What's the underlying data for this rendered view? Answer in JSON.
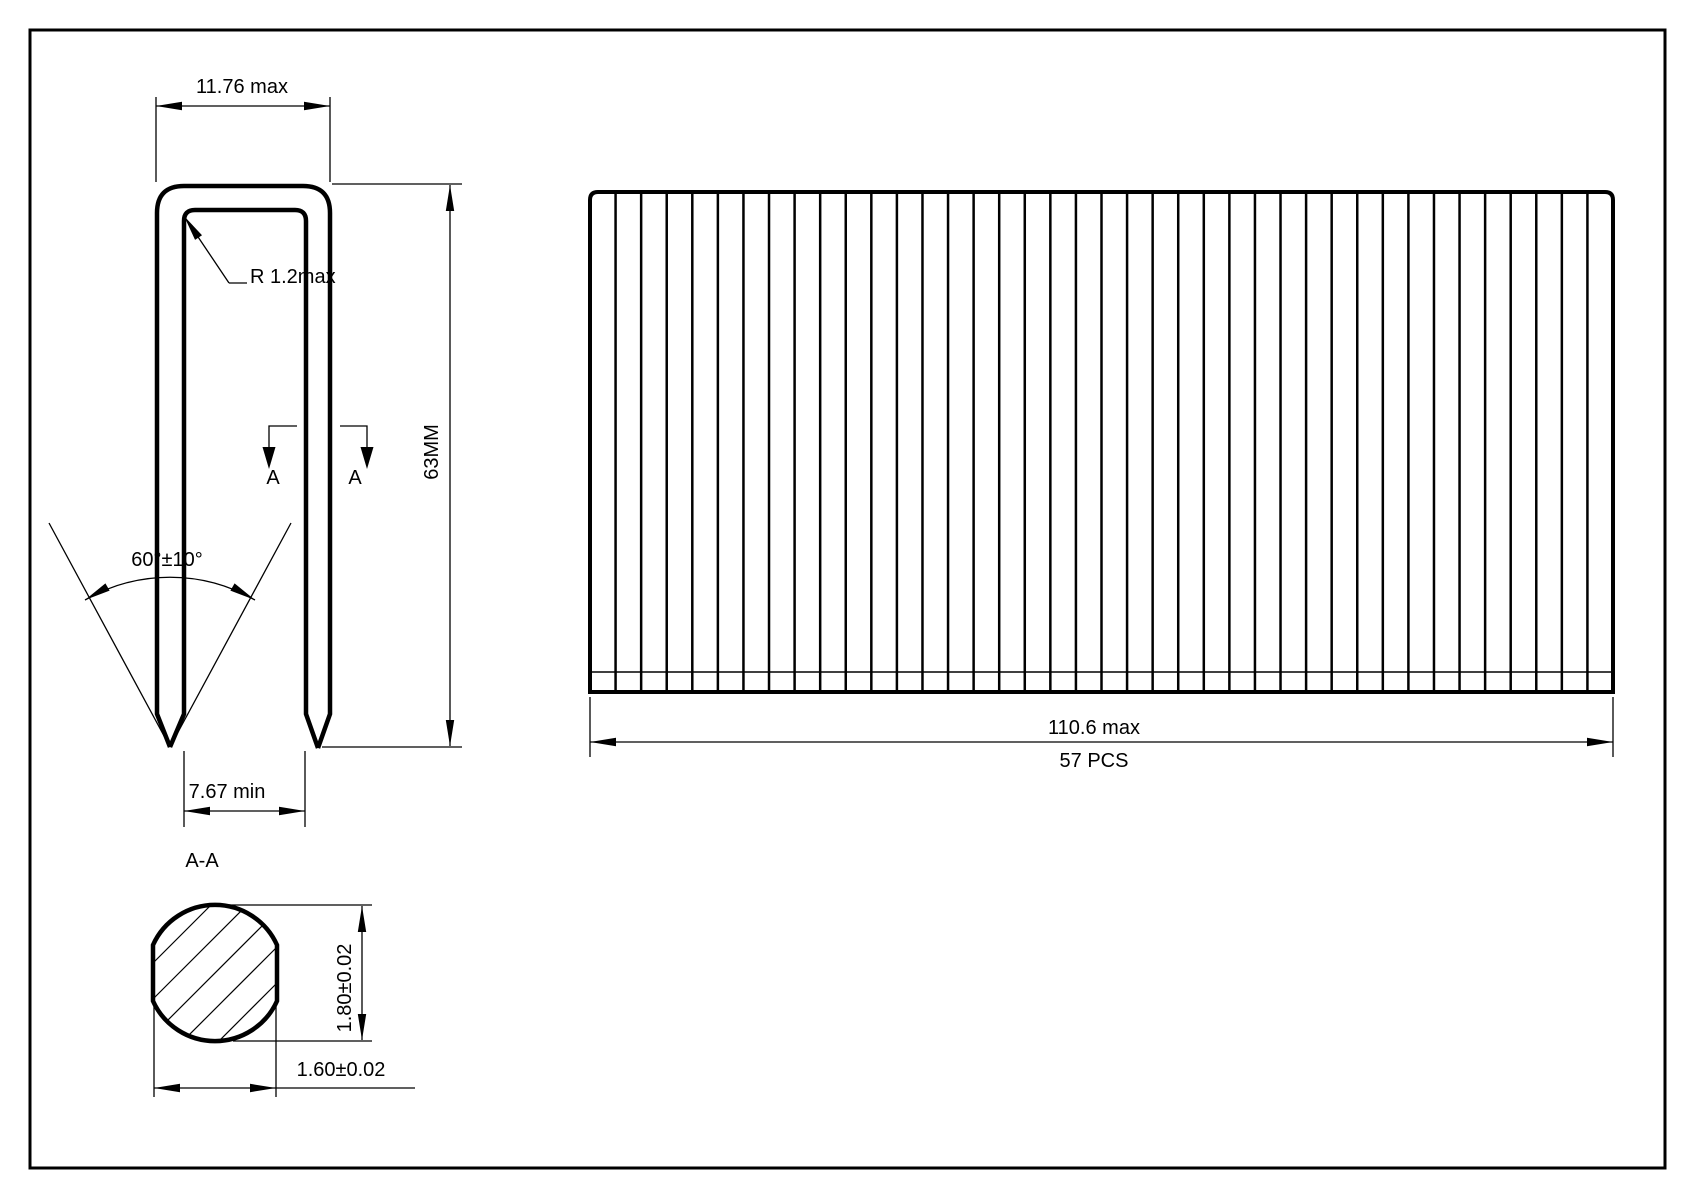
{
  "drawing": {
    "title": "Staple engineering drawing"
  },
  "front_view": {
    "crown_width_label": "11.76 max",
    "radius_label": "R 1.2max",
    "leg_length_label": "63MM",
    "point_angle_label": "60°±10°",
    "inside_span_label": "7.67 min",
    "section_marker_left": "A",
    "section_marker_right": "A"
  },
  "strip_view": {
    "length_label": "110.6 max",
    "pieces_label": "57 PCS",
    "staple_line_count": 39
  },
  "section_view": {
    "title_label": "A-A",
    "height_label": "1.80±0.02",
    "width_label": "1.60±0.02"
  },
  "colors": {
    "line": "#000000",
    "background": "#ffffff"
  }
}
